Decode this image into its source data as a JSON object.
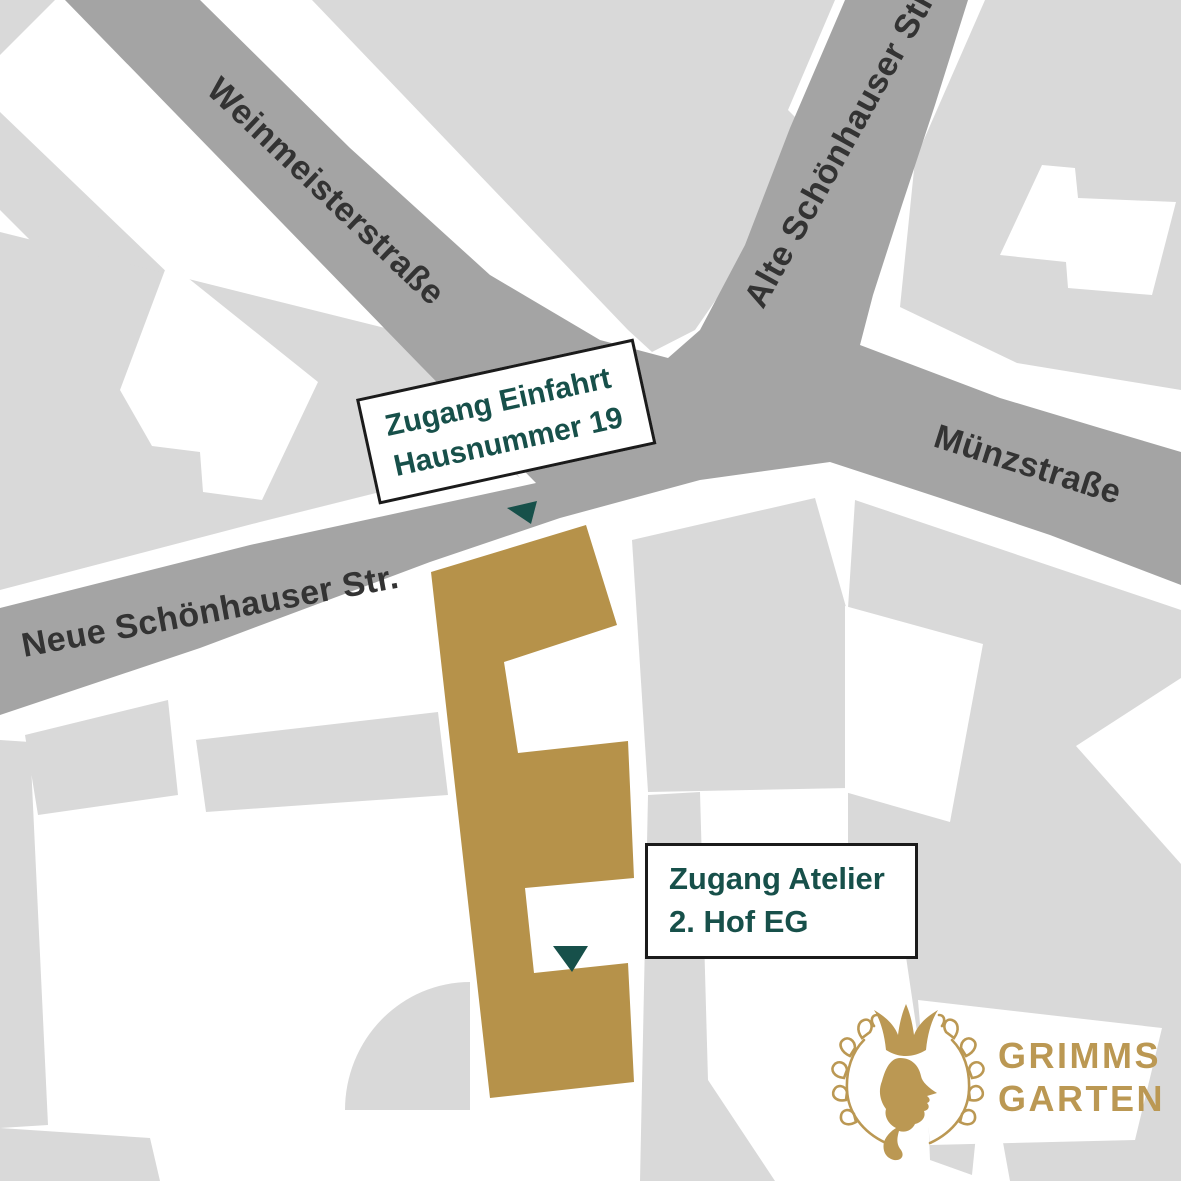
{
  "streets": {
    "weinmeister": "Weinmeisterstraße",
    "alte_schoenhauser": "Alte Schönhauser Str.",
    "muenz": "Münzstraße",
    "neue_schoenhauser": "Neue Schönhauser Str."
  },
  "annotations": {
    "einfahrt": {
      "line1": "Zugang Einfahrt",
      "line2": "Hausnummer 19"
    },
    "atelier": {
      "line1": "Zugang Atelier",
      "line2": "2. Hof EG"
    }
  },
  "logo": {
    "line1": "GRIMMS",
    "line2": "GARTEN"
  },
  "markers": {
    "einfahrt_icon": "triangle-down",
    "atelier_icon": "triangle-down"
  },
  "colors": {
    "background": "#ffffff",
    "road": "#a4a4a4",
    "block": "#d9d9d9",
    "building": "#b6924a",
    "marker": "#17504a",
    "label_text": "#17504a",
    "street_text": "#333333",
    "logo_gold": "#bb9853",
    "outline": "#1b1b1b"
  }
}
